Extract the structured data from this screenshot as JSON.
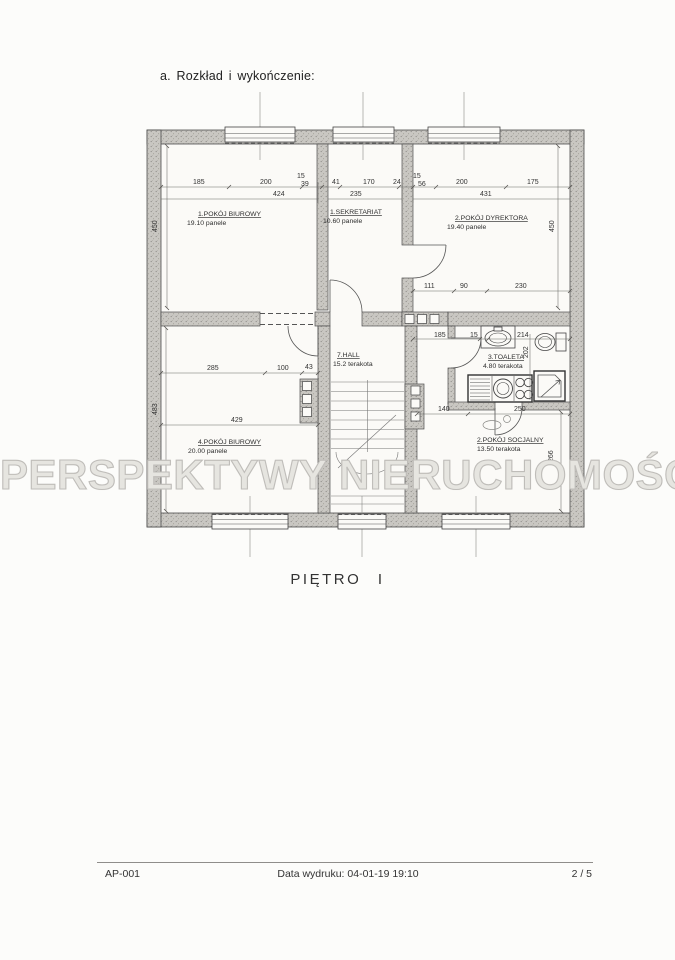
{
  "page": {
    "header": "a.  Rozkład i wykończenie:",
    "caption": "PIĘTRO I",
    "watermark": "PERSPEKTYWY NIERUCHOMOŚCI",
    "footer": {
      "doc_id": "AP-001",
      "print_date": "Data wydruku: 04-01-19 19:10",
      "page_num": "2 / 5"
    }
  },
  "plan": {
    "rooms": [
      {
        "name": "1.POKÓJ BIUROWY",
        "detail": "19.10 panele"
      },
      {
        "name": "1.SEKRETARIAT",
        "detail": "10.60 panele"
      },
      {
        "name": "2.POKÓJ DYREKTORA",
        "detail": "19.40 panele"
      },
      {
        "name": "7.HALL",
        "detail": "15.2 terakota"
      },
      {
        "name": "3.TOALETA",
        "detail": "4.80 terakota"
      },
      {
        "name": "4.POKÓJ BIUROWY",
        "detail": "20.00 panele"
      },
      {
        "name": "2.POKÓJ SOCJALNY",
        "detail": "13.50 terakota"
      }
    ],
    "dims": [
      "185",
      "200",
      "15",
      "39",
      "41",
      "424",
      "170",
      "24",
      "15",
      "56",
      "235",
      "200",
      "175",
      "431",
      "450",
      "450",
      "111",
      "90",
      "230",
      "185",
      "15",
      "214",
      "202",
      "285",
      "100",
      "43",
      "429",
      "483",
      "140",
      "250",
      "266"
    ],
    "colors": {
      "wall_fill": "#c9c7c2",
      "line": "#4d4d4d",
      "paper": "#fcfcfa"
    }
  }
}
